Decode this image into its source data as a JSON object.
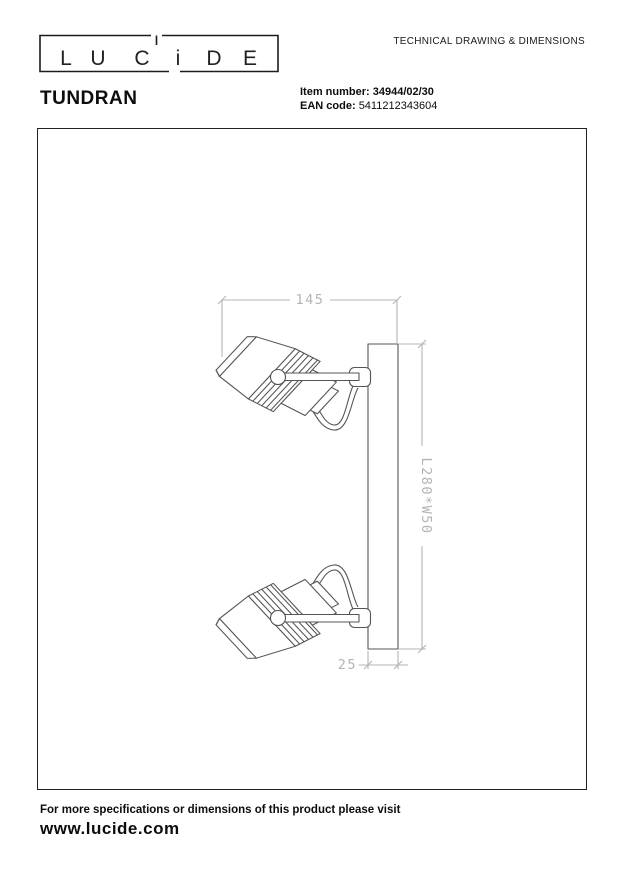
{
  "header": {
    "logo_letters": [
      "L",
      "U",
      "C",
      "i",
      "D",
      "E"
    ],
    "doc_title": "TECHNICAL DRAWING & DIMENSIONS",
    "product_name": "TUNDRAN",
    "item_label": "Item number:",
    "item_value": "34944/02/30",
    "ean_label": "EAN code:",
    "ean_value": "5411212343604"
  },
  "drawing": {
    "dim_width": "145",
    "dim_length": "L280*W50",
    "dim_depth": "25"
  },
  "footer": {
    "note": "For more specifications or dimensions of this product please visit",
    "website": "www.lucide.com"
  },
  "colors": {
    "line": "#555555",
    "dimension": "#b4b4b4",
    "text": "#111111"
  }
}
